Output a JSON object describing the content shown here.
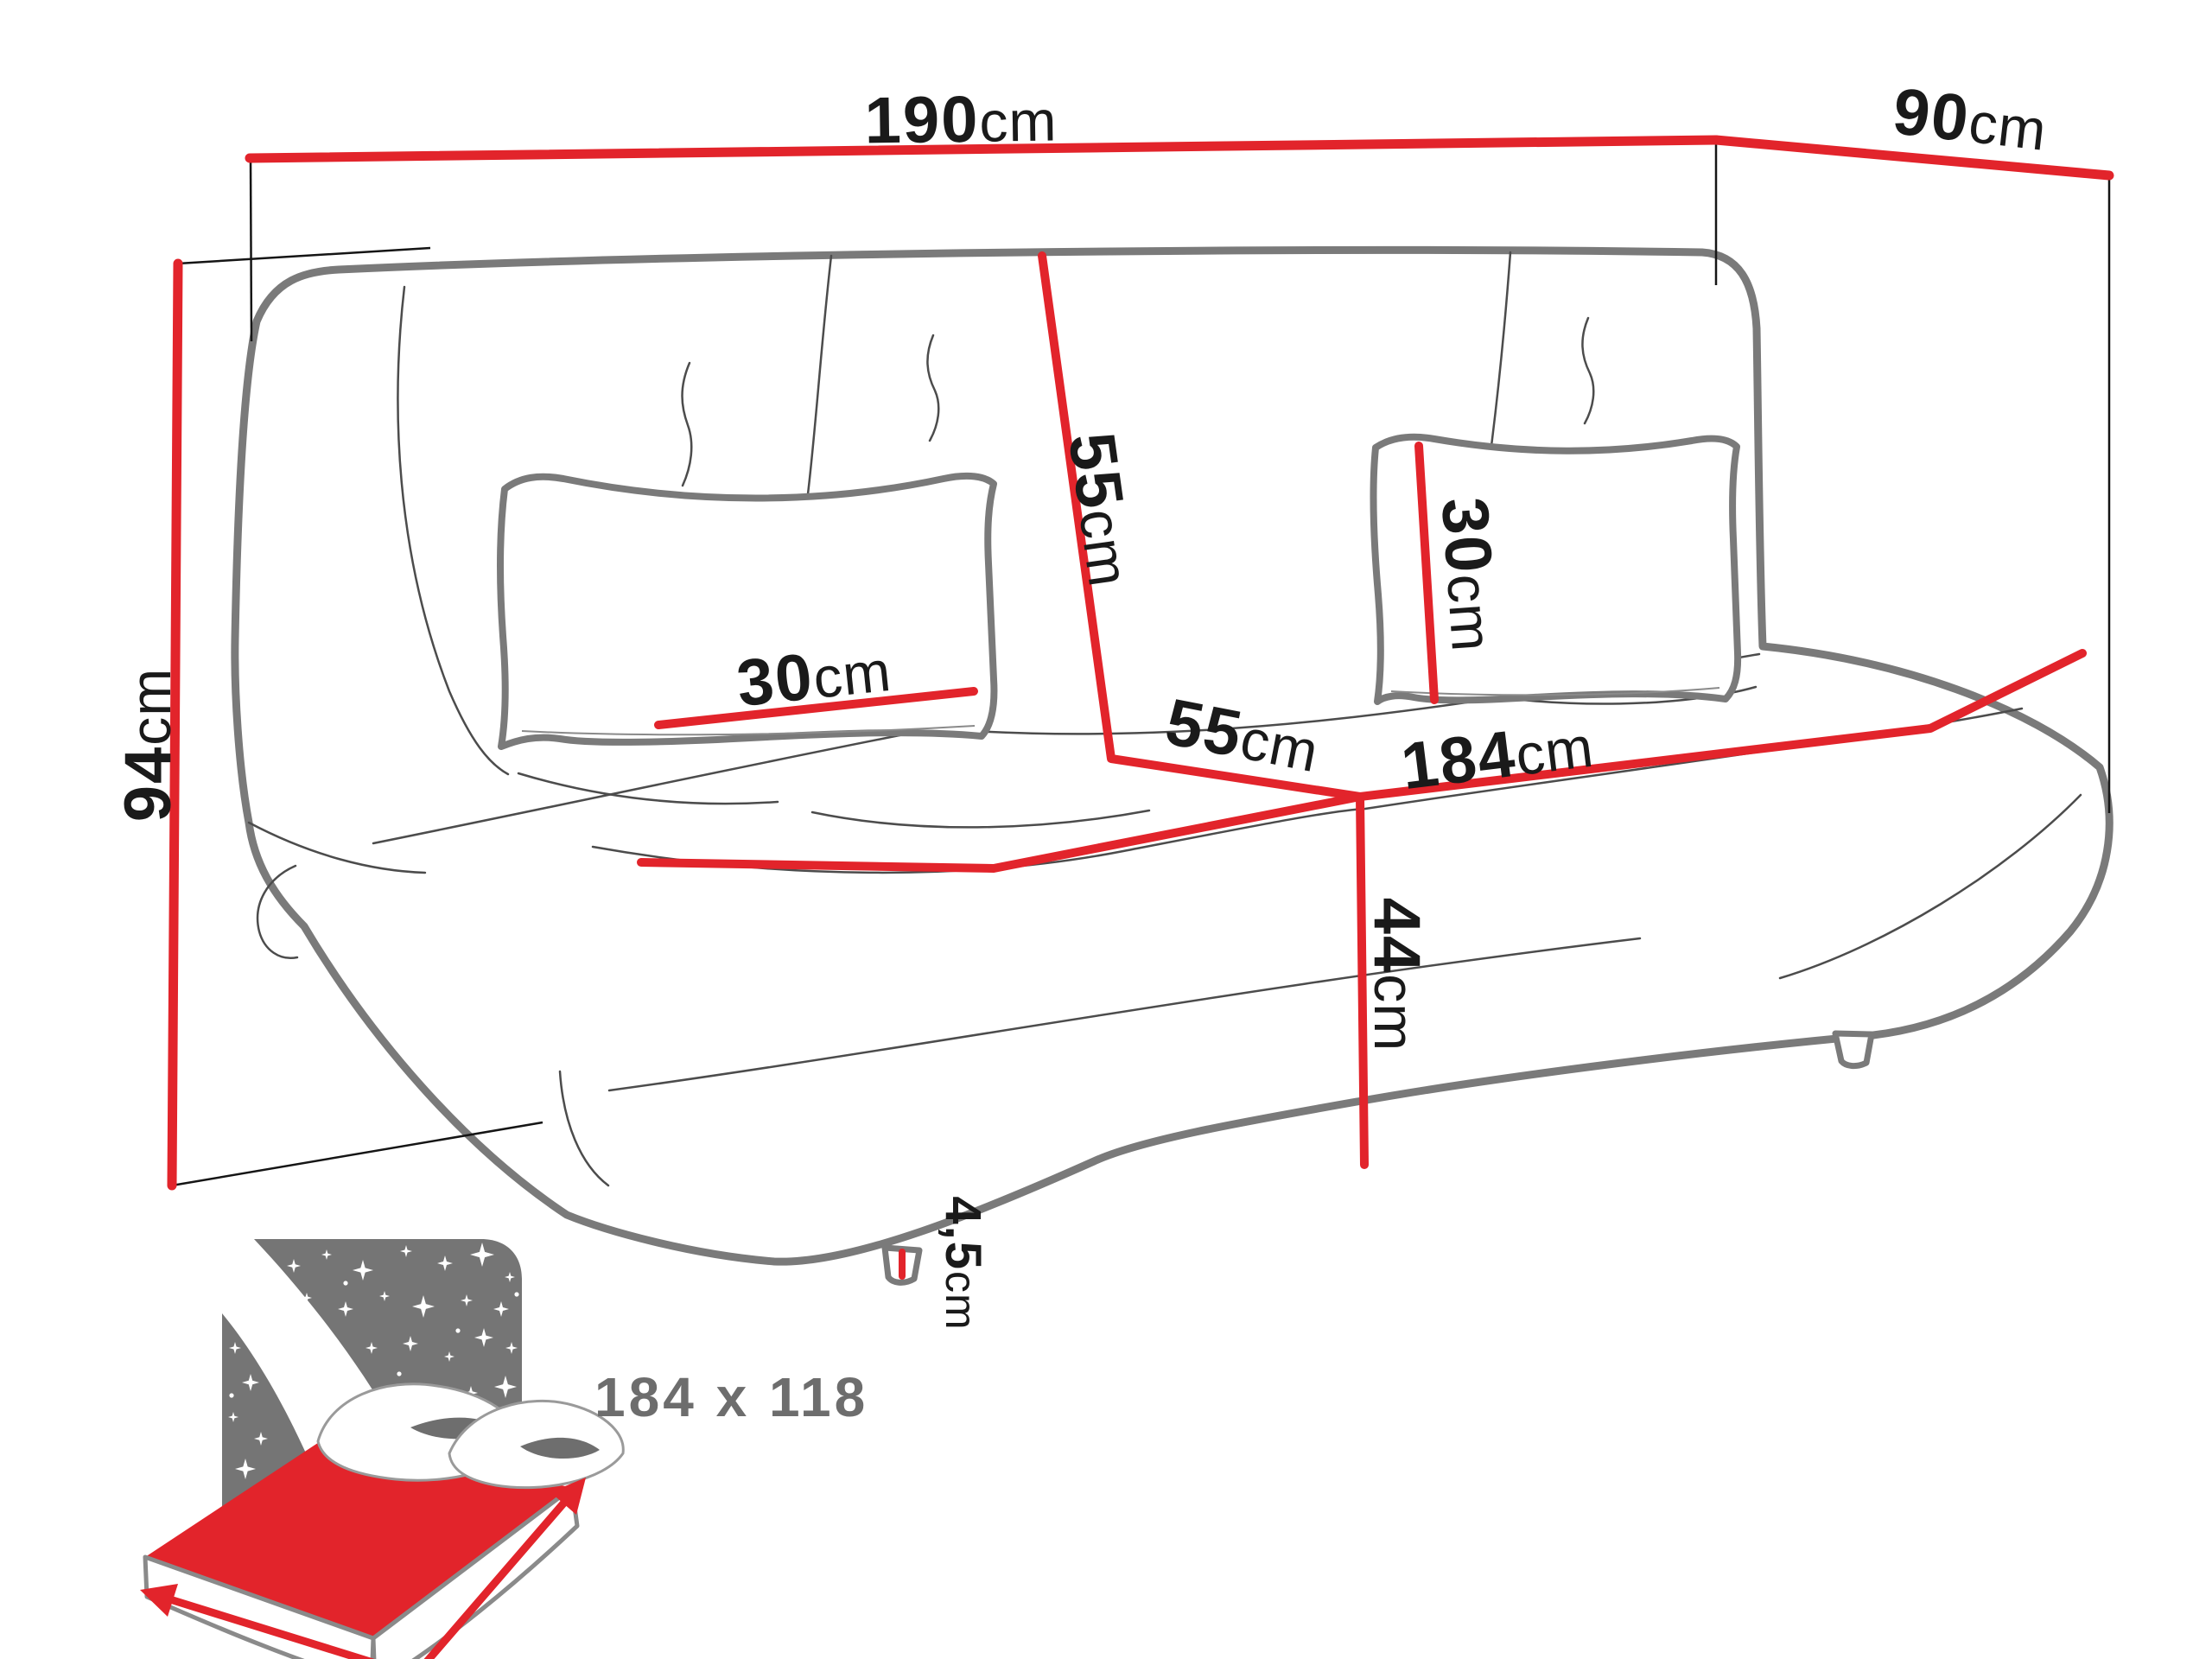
{
  "diagram": {
    "title_hint": "sofa-bed dimension diagram",
    "labels": {
      "width_top": {
        "value": "190",
        "unit": "cm"
      },
      "depth_top": {
        "value": "90",
        "unit": "cm"
      },
      "height_left": {
        "value": "94",
        "unit": "cm"
      },
      "backrest_height": {
        "value": "55",
        "unit": "cm"
      },
      "pillow_left_width": {
        "value": "30",
        "unit": "cm"
      },
      "pillow_right_width": {
        "value": "30",
        "unit": "cm"
      },
      "seat_depth": {
        "value": "55",
        "unit": "cm"
      },
      "seat_width": {
        "value": "184",
        "unit": "cm"
      },
      "seat_height": {
        "value": "44",
        "unit": "cm"
      },
      "leg_height": {
        "value": "4,5",
        "unit": "cm"
      }
    },
    "sleeping_area": {
      "label": "184 x 118"
    },
    "colors": {
      "dimension_red": "#e2242b",
      "outline_gray": "#7a7a7a",
      "seam_gray": "#4c4c4c",
      "icon_gray": "#757575",
      "icon_shadow_gray": "#6e6e6e",
      "label_black": "#1a1a1a",
      "sleeping_text_gray": "#6d6d6d"
    },
    "icons": [
      {
        "name": "sleeping-area-bed-icon",
        "meaning": "fold-out sleeping surface size"
      }
    ]
  }
}
